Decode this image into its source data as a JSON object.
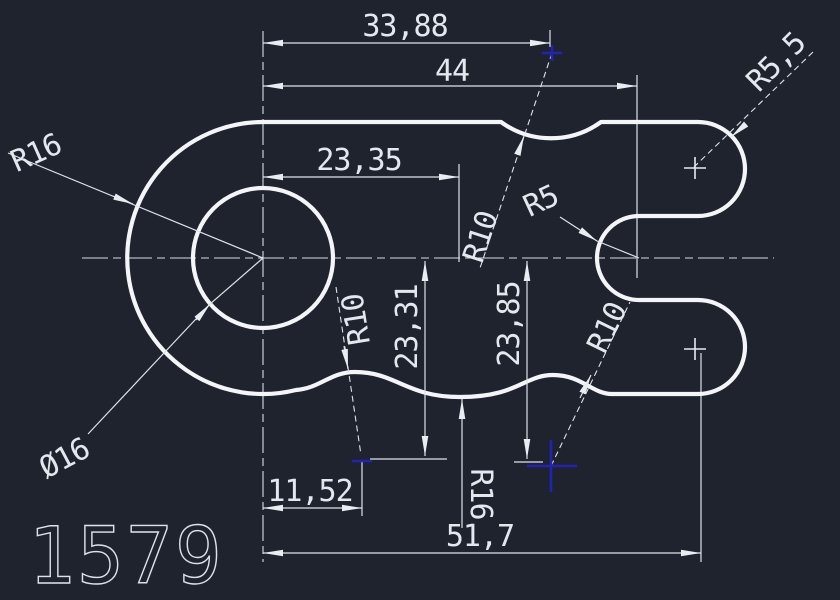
{
  "drawing": {
    "number": "1579",
    "colors": {
      "background": "#1e232e",
      "lines": "#e8edf2",
      "marker_blue": "#2222b4"
    },
    "dimensions": {
      "width_top": "33,88",
      "width_overall_top": "44",
      "width_mid": "23,35",
      "width_bottom_left": "11,52",
      "width_overall_bottom": "51,7",
      "height_left": "23,31",
      "height_right": "23,85"
    },
    "radii": {
      "lobe_radius": "R16",
      "hole_diameter": "Ø16",
      "top_dip_radius": "R10",
      "slot_end_radius": "R5",
      "prong_cap_radius": "R5,5",
      "wave_left_radius": "R10",
      "wave_right_radius": "R10",
      "wave_sag_radius": "R16"
    }
  }
}
